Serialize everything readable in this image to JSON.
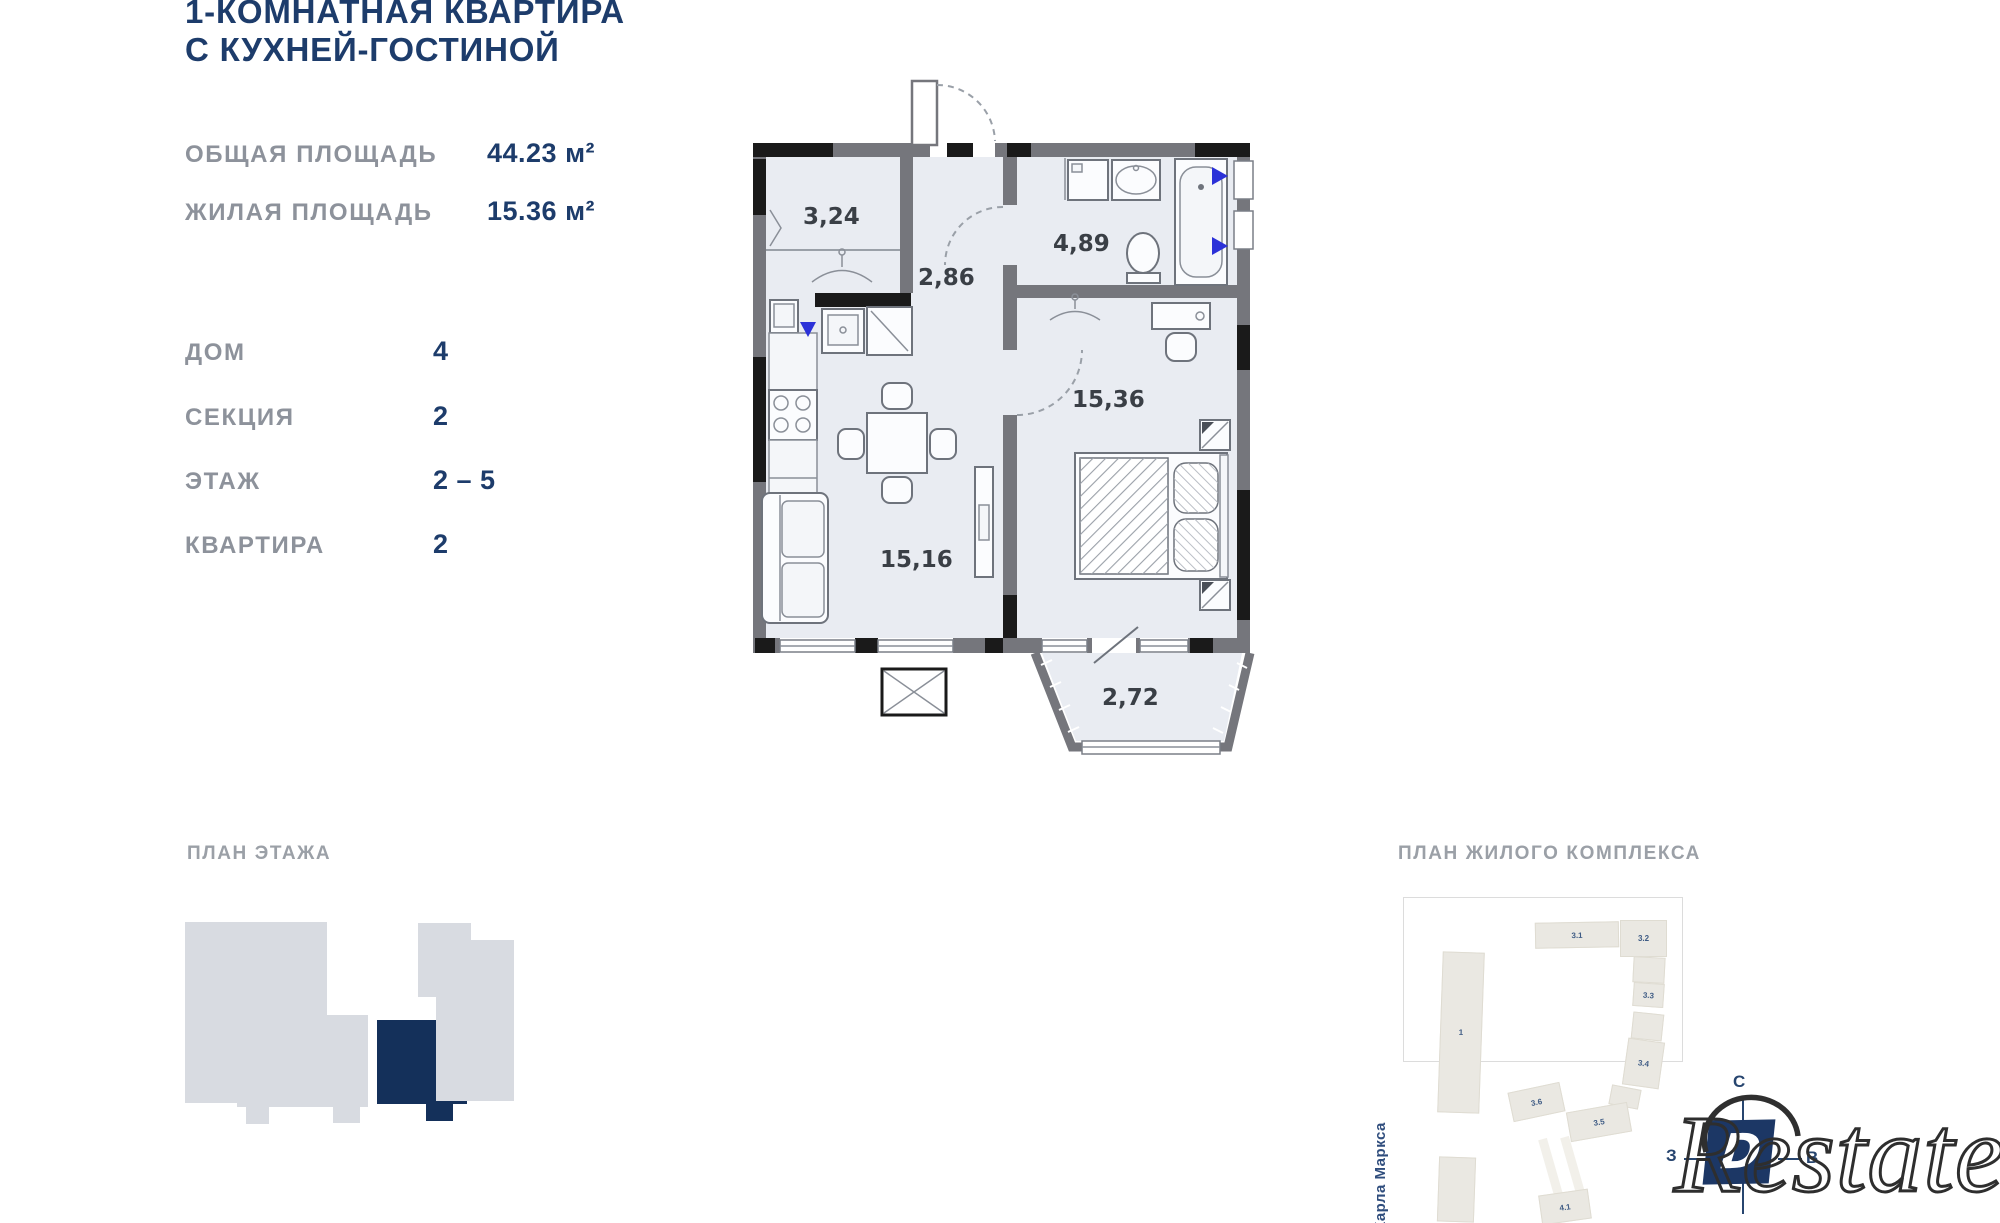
{
  "header": {
    "title_line1": "1-КОМНАТНАЯ КВАРТИРА",
    "title_line2": "С КУХНЕЙ-ГОСТИНОЙ"
  },
  "areas": {
    "rows": [
      {
        "label": "ОБЩАЯ ПЛОЩАДЬ",
        "value": "44.23 м²"
      },
      {
        "label": "ЖИЛАЯ ПЛОЩАДЬ",
        "value": "15.36 м²"
      }
    ]
  },
  "details": {
    "rows": [
      {
        "label": "ДОМ",
        "value": "4"
      },
      {
        "label": "СЕКЦИЯ",
        "value": "2"
      },
      {
        "label": "ЭТАЖ",
        "value": "2 – 5"
      },
      {
        "label": "КВАРТИРА",
        "value": "2"
      }
    ]
  },
  "floorplan": {
    "rooms": {
      "hallway": "3,24",
      "corridor": "2,86",
      "bathroom": "4,89",
      "bedroom": "15,36",
      "living": "15,16",
      "balcony": "2,72"
    }
  },
  "floor_section": {
    "title": "ПЛАН ЭТАЖА"
  },
  "complex_section": {
    "title": "ПЛАН ЖИЛОГО КОМПЛЕКСА",
    "street": "Карла Маркса",
    "buildings": [
      {
        "label": "3.1"
      },
      {
        "label": "3.2"
      },
      {
        "label": "3.3"
      },
      {
        "label": "3.4"
      },
      {
        "label": "3.6"
      },
      {
        "label": "3.5"
      },
      {
        "label": "4.1"
      },
      {
        "label": "1"
      }
    ],
    "compass": {
      "north": "С",
      "west": "З",
      "east": "В"
    }
  },
  "watermark": {
    "text": "Restate",
    "logo_letter": "D"
  },
  "colors": {
    "navy": "#1d3c6b",
    "grey_label": "#8d929b",
    "plan_fill": "#e9ecf2",
    "highlight_navy": "#14305a",
    "marker_blue": "#2b31d8"
  }
}
